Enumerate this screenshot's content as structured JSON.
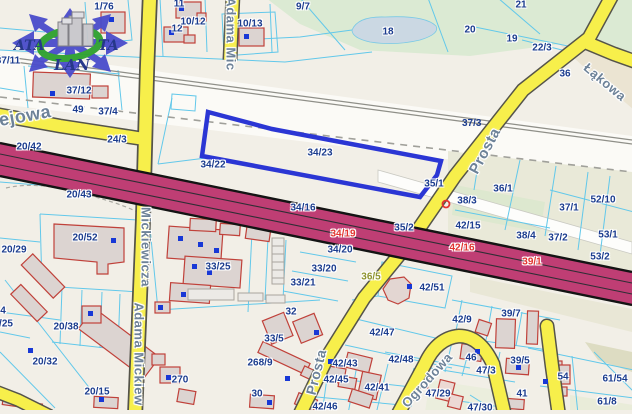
{
  "selected_parcel": "34/23",
  "colors": {
    "background": "#f2efe7",
    "road_minor": "#f7ef4b",
    "road_major": "#bf3e74",
    "parcel_line": "#62c8ea",
    "parcel_label": "#1b3c8e",
    "road_parcel_label_red": "#e23430",
    "road_parcel_label_olive": "#8f9430",
    "street_label": "#6d8298",
    "highlight_parcel": "#2b36d4",
    "field_green": "#dbead3",
    "field_khaki": "#e9e9d8",
    "water": "#cbd8e3",
    "building_fill": "#dcd4d1",
    "building_stroke": "#c0413a",
    "address_point": "#1838d6"
  },
  "logo": {
    "top_left": "ATA",
    "top_right": "TA",
    "bottom": "LAN"
  },
  "svg_labels": {
    "p373": "37/3"
  },
  "street_labels": [
    {
      "t": "Adama Mic",
      "x": 231,
      "y": 34,
      "r": 90,
      "s": 13
    },
    {
      "t": "Mickiewicza",
      "x": 146,
      "y": 247,
      "r": 90,
      "s": 13
    },
    {
      "t": "Adama Mickiew",
      "x": 139,
      "y": 354,
      "r": 90,
      "s": 13
    },
    {
      "t": "ejowa",
      "x": 25,
      "y": 116,
      "r": -10,
      "s": 18
    },
    {
      "t": "Prosta",
      "x": 485,
      "y": 151,
      "r": -62,
      "s": 15
    },
    {
      "t": "Prosta",
      "x": 316,
      "y": 372,
      "r": -76,
      "s": 14
    },
    {
      "t": "Łąkowa",
      "x": 605,
      "y": 82,
      "r": 40,
      "s": 13
    },
    {
      "t": "Ogrodowa",
      "x": 427,
      "y": 380,
      "r": -48,
      "s": 13
    }
  ],
  "parcel_labels": [
    {
      "t": "1/76",
      "x": 104,
      "y": 7
    },
    {
      "t": "11",
      "x": 179,
      "y": 4
    },
    {
      "t": "12",
      "x": 177,
      "y": 29
    },
    {
      "t": "10/12",
      "x": 193,
      "y": 22
    },
    {
      "t": "10/13",
      "x": 250,
      "y": 24
    },
    {
      "t": "9/7",
      "x": 303,
      "y": 7
    },
    {
      "t": "18",
      "x": 388,
      "y": 32
    },
    {
      "t": "20",
      "x": 470,
      "y": 30
    },
    {
      "t": "21",
      "x": 521,
      "y": 5
    },
    {
      "t": "19",
      "x": 512,
      "y": 39
    },
    {
      "t": "22/3",
      "x": 542,
      "y": 48
    },
    {
      "t": "36",
      "x": 565,
      "y": 74
    },
    {
      "t": "37/11",
      "x": 8,
      "y": 61
    },
    {
      "t": "37/12",
      "x": 79,
      "y": 91
    },
    {
      "t": "49",
      "x": 78,
      "y": 110
    },
    {
      "t": "37/4",
      "x": 108,
      "y": 112
    },
    {
      "t": "24/3",
      "x": 117,
      "y": 140
    },
    {
      "t": "20/42",
      "x": 29,
      "y": 147
    },
    {
      "t": "20/43",
      "x": 79,
      "y": 195
    },
    {
      "t": "34/22",
      "x": 213,
      "y": 165
    },
    {
      "t": "34/23",
      "x": 320,
      "y": 153
    },
    {
      "t": "35/1",
      "x": 434,
      "y": 184
    },
    {
      "t": "35/2",
      "x": 404,
      "y": 228
    },
    {
      "t": "36/1",
      "x": 503,
      "y": 189
    },
    {
      "t": "38/3",
      "x": 467,
      "y": 201
    },
    {
      "t": "42/15",
      "x": 468,
      "y": 226
    },
    {
      "t": "38/4",
      "x": 526,
      "y": 236
    },
    {
      "t": "37/2",
      "x": 558,
      "y": 238
    },
    {
      "t": "37/1",
      "x": 569,
      "y": 208
    },
    {
      "t": "52/10",
      "x": 603,
      "y": 200
    },
    {
      "t": "53/1",
      "x": 608,
      "y": 235
    },
    {
      "t": "53/2",
      "x": 600,
      "y": 257
    },
    {
      "t": "34/16",
      "x": 303,
      "y": 208
    },
    {
      "t": "34/19",
      "x": 343,
      "y": 234,
      "c": "red"
    },
    {
      "t": "42/16",
      "x": 462,
      "y": 248,
      "c": "red"
    },
    {
      "t": "39/1",
      "x": 532,
      "y": 262,
      "c": "red"
    },
    {
      "t": "36/5",
      "x": 371,
      "y": 277,
      "c": "olive"
    },
    {
      "t": "34/20",
      "x": 340,
      "y": 250
    },
    {
      "t": "33/20",
      "x": 324,
      "y": 269
    },
    {
      "t": "33/21",
      "x": 303,
      "y": 283
    },
    {
      "t": "33/25",
      "x": 218,
      "y": 267
    },
    {
      "t": "42/51",
      "x": 432,
      "y": 288
    },
    {
      "t": "42/9",
      "x": 462,
      "y": 320
    },
    {
      "t": "39/7",
      "x": 511,
      "y": 314
    },
    {
      "t": "42/47",
      "x": 382,
      "y": 333
    },
    {
      "t": "42/48",
      "x": 401,
      "y": 360
    },
    {
      "t": "42/43",
      "x": 345,
      "y": 364
    },
    {
      "t": "42/45",
      "x": 336,
      "y": 380
    },
    {
      "t": "42/41",
      "x": 377,
      "y": 388
    },
    {
      "t": "42/46",
      "x": 325,
      "y": 407
    },
    {
      "t": "268/9",
      "x": 260,
      "y": 363
    },
    {
      "t": "33/5",
      "x": 274,
      "y": 339
    },
    {
      "t": "32",
      "x": 291,
      "y": 312
    },
    {
      "t": "30",
      "x": 257,
      "y": 394
    },
    {
      "t": "20/52",
      "x": 85,
      "y": 238
    },
    {
      "t": "20/29",
      "x": 14,
      "y": 250
    },
    {
      "t": "20/38",
      "x": 66,
      "y": 327
    },
    {
      "t": "4",
      "x": 3,
      "y": 311
    },
    {
      "t": "/25",
      "x": 6,
      "y": 324
    },
    {
      "t": "20/32",
      "x": 45,
      "y": 362
    },
    {
      "t": "20/15",
      "x": 97,
      "y": 392
    },
    {
      "t": "270",
      "x": 180,
      "y": 380
    },
    {
      "t": "46",
      "x": 471,
      "y": 358
    },
    {
      "t": "47/3",
      "x": 486,
      "y": 371
    },
    {
      "t": "47/29",
      "x": 438,
      "y": 394
    },
    {
      "t": "47/30",
      "x": 480,
      "y": 408
    },
    {
      "t": "41",
      "x": 522,
      "y": 394
    },
    {
      "t": "39/5",
      "x": 520,
      "y": 361
    },
    {
      "t": "54",
      "x": 563,
      "y": 377
    },
    {
      "t": "61/54",
      "x": 615,
      "y": 379
    },
    {
      "t": "61/8",
      "x": 607,
      "y": 402
    }
  ]
}
